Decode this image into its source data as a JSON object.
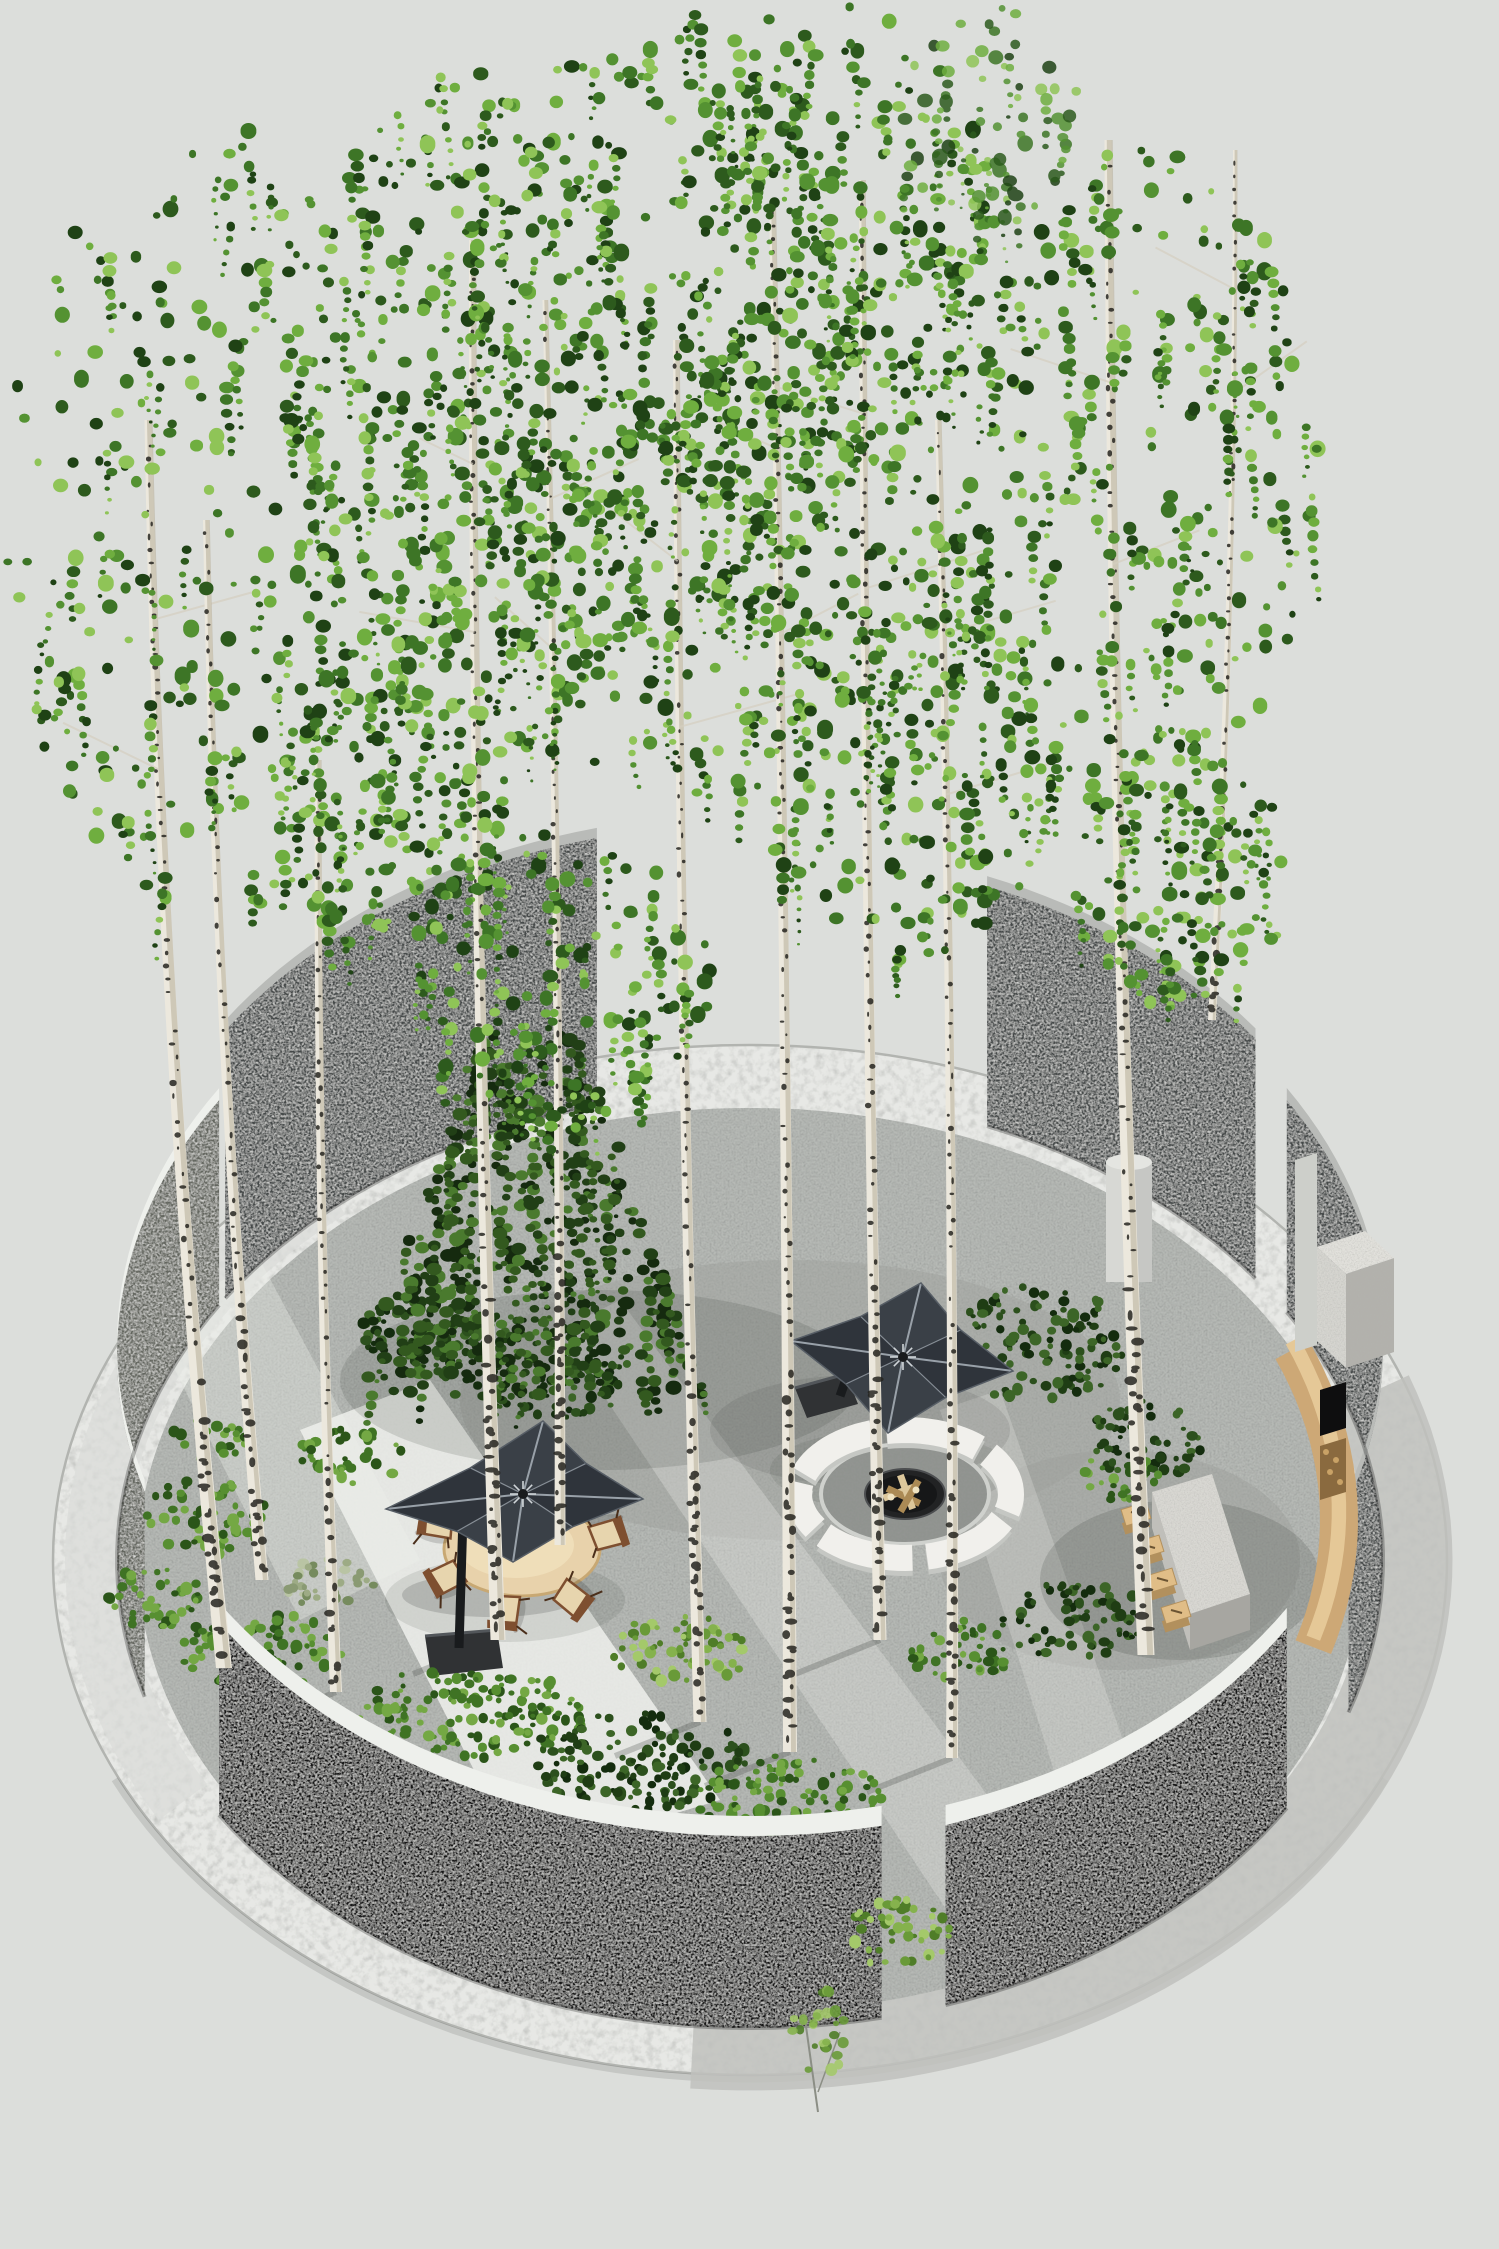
{
  "meta": {
    "title": "Circular birch-grove garden — 3D landscape visualization",
    "description": "Axonometric render of a round walled garden with birch trees, a spruce, two dark cantilever umbrellas, round dining table with wooden chairs, sunken fire pit with white curved benches, stone kitchen island with log stools, curved wooden bench and outdoor fireplace, all ringed by curved walls and a white gravel band."
  },
  "palette": {
    "bg": "#dcdedb",
    "ringLight": "#e7e8e5",
    "ringRim": "#b2b4b0",
    "apron": "#bfc1bd",
    "apronLight": "#dadcd8",
    "paving": "#b6b9b5",
    "pavingDark": "#9da09c",
    "pavingBright": "#eef0ec",
    "wallDark": "#45484a",
    "wallGray": "#63665f",
    "wallBlack": "#141516",
    "wallCap": "#eef0ec",
    "wallCapGray": "#b9bbb8",
    "birchTrunk": "#ece8dd",
    "birchShade": "#b7ad97",
    "birchFleck": "#262420",
    "woodTable": "#e8d2ab",
    "tableEdge": "#c8a873",
    "chairWood": "#7e4f30",
    "chairLeg": "#4a2e1a",
    "cushion": "#e7d5ae",
    "umbTop": "#3a4047",
    "umbDark": "#2f343b",
    "umbRib": "#99a1a9",
    "umbFrame": "#191b1d",
    "benchWhite": "#f1f0ec",
    "benchWhiteShade": "#c5c7c3",
    "pitInner": "#90938f",
    "pitRim": "#cfd1cd",
    "bowl": "#222324",
    "bowlDark": "#161718",
    "log": "#dcc79b",
    "logDark": "#ab8a55",
    "islandTop": "#d9d8d3",
    "islandSideL": "#c0bfba",
    "islandSideF": "#a7a6a1",
    "stoolTop": "#e0bd87",
    "stoolSide": "#b2905d",
    "benchWood": "#cda876",
    "benchWoodHi": "#e5c897",
    "chimney": "#d6d5d0",
    "chimneyShade": "#b2b1ac",
    "slab": "#cdcfca",
    "firebox": "#0e0e0f",
    "woodStore": "#8a6a3f",
    "cylinder": "#d7d8d4",
    "cylShade": "#c2c3bf",
    "cylTop": "#e4e5e1"
  },
  "foliage": {
    "birch": [
      "#8fc457",
      "#6fae3f",
      "#549232",
      "#3d7526",
      "#2d5a1d",
      "#1f4215"
    ],
    "shrub": [
      "#74a844",
      "#578f31",
      "#3f7324",
      "#2b5519"
    ],
    "dark": [
      "#3c6527",
      "#2c501d",
      "#1f3d14",
      "#142c0e"
    ],
    "light": [
      "#a4c96a",
      "#85b24d",
      "#699a38",
      "#4f7d28"
    ],
    "sage": [
      "#b9c4a4",
      "#9dab85",
      "#8a9a73",
      "#768b5e"
    ],
    "spruce": [
      "#4a7a2e",
      "#33591f",
      "#213f16",
      "#152a0f"
    ]
  },
  "scene": {
    "disc": {
      "cx": 750,
      "cy": 1560,
      "rxOuter": 697,
      "ryOuter": 515,
      "rxInner": 612,
      "ryInner": 452,
      "rxWall": 633,
      "ryWall": 468
    },
    "walls": [
      {
        "id": "wall-upper-left",
        "a1": 214,
        "a2": 256,
        "h": 268,
        "face": "wallDark",
        "cap": "wallCapGray",
        "capW": 10,
        "layer": "far"
      },
      {
        "id": "wall-left",
        "a1": 163,
        "a2": 213,
        "h": 205,
        "face": "wallGray",
        "cap": "wallCap",
        "capW": 12,
        "layer": "far"
      },
      {
        "id": "wall-upper-right",
        "a1": 292,
        "a2": 323,
        "h": 240,
        "face": "wallDark",
        "cap": "wallCapGray",
        "capW": 10,
        "layer": "far"
      },
      {
        "id": "wall-right",
        "a1": 328,
        "a2": 379,
        "h": 212,
        "face": "wallDark",
        "cap": "wallCapGray",
        "capW": 12,
        "layer": "mid"
      },
      {
        "id": "wall-bottom-right",
        "a1": 32,
        "a2": 72,
        "h": 180,
        "face": "wallBlack",
        "cap": "wallCap",
        "capW": 20,
        "layer": "near"
      },
      {
        "id": "wall-bottom-left",
        "a1": 78,
        "a2": 147,
        "h": 192,
        "face": "wallBlack",
        "cap": "wallCap",
        "capW": 20,
        "layer": "near"
      }
    ],
    "trunks": [
      [
        224,
        1668,
        148,
        420,
        16,
        7,
        -26
      ],
      [
        262,
        1580,
        206,
        520,
        13,
        6,
        -18
      ],
      [
        336,
        1692,
        318,
        760,
        12,
        6,
        -10
      ],
      [
        498,
        1640,
        472,
        240,
        15,
        6,
        -12
      ],
      [
        560,
        1545,
        545,
        300,
        11,
        5,
        8
      ],
      [
        700,
        1722,
        676,
        340,
        13,
        6,
        -8
      ],
      [
        790,
        1752,
        772,
        200,
        14,
        6,
        6
      ],
      [
        880,
        1640,
        862,
        180,
        13,
        6,
        -6
      ],
      [
        952,
        1758,
        938,
        420,
        12,
        6,
        10
      ],
      [
        1146,
        1655,
        1108,
        140,
        17,
        7,
        -14
      ],
      [
        1212,
        1020,
        1235,
        150,
        8,
        4,
        12
      ]
    ],
    "canopies": [
      {
        "cx": 235,
        "cy": 520,
        "rx": 235,
        "ry": 400,
        "n": 320
      },
      {
        "cx": 470,
        "cy": 430,
        "rx": 185,
        "ry": 360,
        "n": 300
      },
      {
        "cx": 660,
        "cy": 330,
        "rx": 225,
        "ry": 320,
        "n": 330
      },
      {
        "cx": 830,
        "cy": 250,
        "rx": 165,
        "ry": 250,
        "n": 260
      },
      {
        "cx": 700,
        "cy": 585,
        "rx": 290,
        "ry": 210,
        "n": 300
      },
      {
        "cx": 1120,
        "cy": 470,
        "rx": 205,
        "ry": 330,
        "n": 300
      },
      {
        "cx": 990,
        "cy": 115,
        "rx": 90,
        "ry": 110,
        "n": 70,
        "sparse": true
      },
      {
        "cx": 385,
        "cy": 790,
        "rx": 120,
        "ry": 160,
        "n": 140
      },
      {
        "cx": 560,
        "cy": 980,
        "rx": 150,
        "ry": 150,
        "n": 160
      },
      {
        "cx": 905,
        "cy": 760,
        "rx": 150,
        "ry": 200,
        "n": 200
      },
      {
        "cx": 1180,
        "cy": 870,
        "rx": 110,
        "ry": 140,
        "n": 130
      }
    ],
    "spruce": {
      "cx": 530,
      "yTop": 1035,
      "yBot": 1390,
      "wTop": 55,
      "wBot": 175
    },
    "shrubs": [
      {
        "cx": 352,
        "cy": 1457,
        "rx": 55,
        "ry": 28,
        "pal": "shrub"
      },
      {
        "cx": 425,
        "cy": 1332,
        "rx": 75,
        "ry": 40,
        "pal": "dark"
      },
      {
        "cx": 560,
        "cy": 1392,
        "rx": 65,
        "ry": 28,
        "pal": "dark"
      },
      {
        "cx": 210,
        "cy": 1438,
        "rx": 40,
        "ry": 22,
        "pal": "shrub"
      },
      {
        "cx": 520,
        "cy": 1355,
        "rx": 110,
        "ry": 40,
        "pal": "dark"
      },
      {
        "cx": 1040,
        "cy": 1345,
        "rx": 85,
        "ry": 60,
        "pal": "dark"
      },
      {
        "cx": 1145,
        "cy": 1440,
        "rx": 62,
        "ry": 40,
        "pal": "dark"
      },
      {
        "cx": 1120,
        "cy": 1478,
        "rx": 42,
        "ry": 24,
        "pal": "shrub"
      }
    ],
    "shrubsNear": [
      {
        "cx": 330,
        "cy": 1586,
        "rx": 46,
        "ry": 28,
        "pal": "sage"
      },
      {
        "cx": 205,
        "cy": 1517,
        "rx": 66,
        "ry": 38,
        "pal": "shrub"
      },
      {
        "cx": 152,
        "cy": 1598,
        "rx": 50,
        "ry": 32,
        "pal": "shrub"
      },
      {
        "cx": 262,
        "cy": 1650,
        "rx": 85,
        "ry": 38,
        "pal": "shrub"
      },
      {
        "cx": 470,
        "cy": 1712,
        "rx": 120,
        "ry": 48,
        "pal": "shrub"
      },
      {
        "cx": 640,
        "cy": 1760,
        "rx": 110,
        "ry": 50,
        "pal": "dark"
      },
      {
        "cx": 790,
        "cy": 1800,
        "rx": 95,
        "ry": 45,
        "pal": "shrub"
      },
      {
        "cx": 1075,
        "cy": 1620,
        "rx": 75,
        "ry": 38,
        "pal": "dark"
      },
      {
        "cx": 960,
        "cy": 1650,
        "rx": 55,
        "ry": 30,
        "pal": "shrub"
      },
      {
        "cx": 680,
        "cy": 1650,
        "rx": 70,
        "ry": 35,
        "pal": "light"
      }
    ],
    "gapBush": {
      "cx": 900,
      "cy": 1934,
      "rx": 52,
      "ry": 36,
      "pal": "light"
    },
    "firepit": {
      "cx": 905,
      "cy": 1494,
      "ringRx": 106,
      "ringRy": 64,
      "ringW": 26,
      "segs": [
        [
          198,
          252
        ],
        [
          260,
          314
        ],
        [
          322,
          376
        ],
        [
          384,
          438
        ],
        [
          446,
          500
        ],
        [
          508,
          550
        ]
      ],
      "innerRx": 84,
      "innerRy": 50,
      "bowlRx": 40,
      "bowlRy": 25
    },
    "table": {
      "cx": 522,
      "cy": 1549,
      "rx": 78,
      "ry": 47
    },
    "chairs": [
      [
        437,
        1524
      ],
      [
        447,
        1578
      ],
      [
        506,
        1611
      ],
      [
        572,
        1598
      ],
      [
        607,
        1534
      ]
    ],
    "umbrellas": [
      {
        "corners": [
          [
            543,
            1421
          ],
          [
            643,
            1499
          ],
          [
            513,
            1562
          ],
          [
            386,
            1509
          ]
        ],
        "hub": [
          523,
          1494
        ],
        "arm": [
          463,
          1516
        ],
        "pole": [
          459,
          1648
        ],
        "base": [
          [
            425,
            1636
          ],
          [
            497,
            1630
          ],
          [
            503,
            1668
          ],
          [
            431,
            1676
          ]
        ]
      },
      {
        "corners": [
          [
            921,
            1283
          ],
          [
            1013,
            1371
          ],
          [
            888,
            1433
          ],
          [
            791,
            1341
          ]
        ],
        "hub": [
          903,
          1357
        ],
        "arm": [
          845,
          1382
        ],
        "pole": [
          840,
          1396
        ],
        "base": [
          [
            795,
            1388
          ],
          [
            846,
            1374
          ],
          [
            858,
            1404
          ],
          [
            807,
            1418
          ]
        ]
      }
    ],
    "island": {
      "top": [
        [
          1152,
          1492
        ],
        [
          1212,
          1474
        ],
        [
          1250,
          1594
        ],
        [
          1190,
          1614
        ]
      ],
      "left": [
        [
          1152,
          1492
        ],
        [
          1190,
          1614
        ],
        [
          1190,
          1650
        ],
        [
          1152,
          1528
        ]
      ],
      "front": [
        [
          1190,
          1614
        ],
        [
          1250,
          1594
        ],
        [
          1250,
          1630
        ],
        [
          1190,
          1650
        ]
      ]
    },
    "stools": [
      [
        1136,
        1514
      ],
      [
        1149,
        1547
      ],
      [
        1162,
        1580
      ],
      [
        1176,
        1612
      ]
    ],
    "bench": {
      "rx": 589,
      "ry": 435,
      "a1": 337,
      "a2": 377,
      "dy": -40,
      "w": 38
    },
    "chimney": {
      "top": [
        [
          1317,
          1247
        ],
        [
          1365,
          1231
        ],
        [
          1394,
          1258
        ],
        [
          1346,
          1274
        ]
      ],
      "frontL": [
        [
          1317,
          1247
        ],
        [
          1346,
          1274
        ],
        [
          1346,
          1368
        ],
        [
          1317,
          1341
        ]
      ],
      "right": [
        [
          1346,
          1274
        ],
        [
          1394,
          1258
        ],
        [
          1394,
          1352
        ],
        [
          1346,
          1368
        ]
      ],
      "slab": [
        [
          1295,
          1160
        ],
        [
          1317,
          1153
        ],
        [
          1317,
          1345
        ],
        [
          1295,
          1352
        ]
      ],
      "firebox": [
        [
          1320,
          1390
        ],
        [
          1346,
          1382
        ],
        [
          1346,
          1428
        ],
        [
          1320,
          1436
        ]
      ],
      "store": [
        [
          1320,
          1446
        ],
        [
          1346,
          1438
        ],
        [
          1346,
          1492
        ],
        [
          1320,
          1500
        ]
      ]
    },
    "column": {
      "x": 1106,
      "y": 1162,
      "w": 46,
      "h": 120
    },
    "lights": [
      {
        "pts": [
          [
            300,
            1430
          ],
          [
            430,
            1380
          ],
          [
            720,
            1800
          ],
          [
            520,
            1860
          ]
        ],
        "o": 0.85
      },
      {
        "pts": [
          [
            560,
            1330
          ],
          [
            620,
            1300
          ],
          [
            1080,
            1920
          ],
          [
            980,
            1960
          ]
        ],
        "o": 0.3
      },
      {
        "pts": [
          [
            940,
            1410
          ],
          [
            1000,
            1390
          ],
          [
            1130,
            1760
          ],
          [
            1060,
            1790
          ]
        ],
        "o": 0.25
      },
      {
        "pts": [
          [
            150,
            1320
          ],
          [
            260,
            1260
          ],
          [
            420,
            1560
          ],
          [
            300,
            1620
          ]
        ],
        "o": 0.35
      }
    ],
    "shades": [
      {
        "cx": 600,
        "cy": 1380,
        "rx": 260,
        "ry": 90,
        "o": 0.16
      },
      {
        "cx": 860,
        "cy": 1430,
        "rx": 150,
        "ry": 55,
        "o": 0.13
      },
      {
        "cx": 505,
        "cy": 1600,
        "rx": 120,
        "ry": 42,
        "o": 0.12
      },
      {
        "cx": 890,
        "cy": 1470,
        "rx": 120,
        "ry": 40,
        "o": 0.12
      },
      {
        "cx": 1180,
        "cy": 1580,
        "rx": 140,
        "ry": 80,
        "o": 0.18
      }
    ],
    "trunkShadows": [
      [
        700,
        1722
      ],
      [
        790,
        1752
      ],
      [
        880,
        1640
      ],
      [
        952,
        1758
      ],
      [
        498,
        1640
      ],
      [
        560,
        1545
      ],
      [
        336,
        1692
      ]
    ],
    "twigs": {
      "x": 818,
      "y": 2052
    }
  }
}
